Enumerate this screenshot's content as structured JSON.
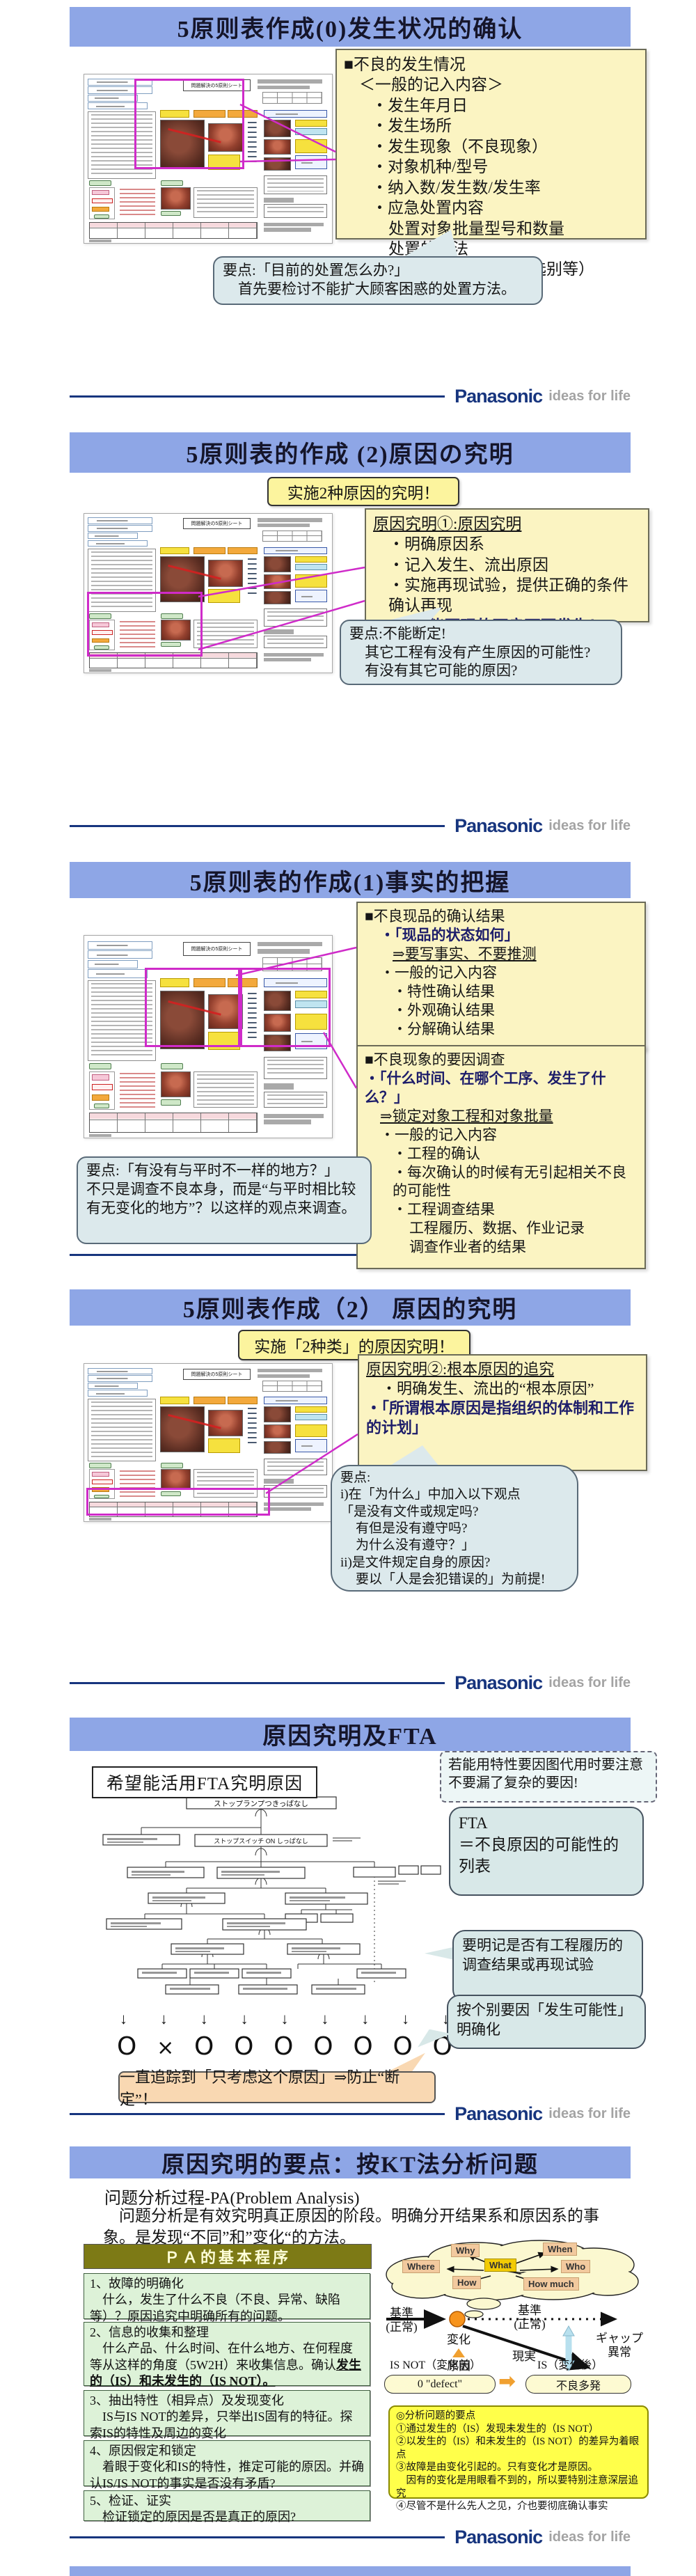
{
  "logo": {
    "brand": "Panasonic",
    "tagline": "ideas for life"
  },
  "form": {
    "title": "問題解決の5原則シート"
  },
  "slide1": {
    "title": "5原则表作成(0)发生状况的确认",
    "info": {
      "l1": "■不良的发生情况",
      "l2": "＜一般的记入内容＞",
      "l3": "・发生年月日",
      "l4": "・发生场所",
      "l5": "・发生现象（不良现象）",
      "l6": "・对象机种/型号",
      "l7": "・纳入数/发生数/发生率",
      "l8": "・应急处置内容",
      "l9": "处置对象批量型号和数量",
      "l10": "处置的方法",
      "l11": "（批量回收、全数选别等）"
    },
    "callout": {
      "l1": "要点:「目前的处置怎么办?」",
      "l2": "首先要检讨不能扩大顾客困惑的处置方法。"
    }
  },
  "slide2": {
    "title": "5原则表的作成 (2)原因の究明",
    "banner": "实施2种原因的究明！",
    "box": {
      "head": "原因究明①:原因究明",
      "l1": "・明确原因系",
      "l2": "・记入发生、流出原因",
      "l3": "・实施再现试验，提供正确的条件确认再现",
      "l4": "・「不能再现的不良可再发生！」"
    },
    "callout": {
      "l1": "要点:不能断定!",
      "l2": "其它工程有没有产生原因的可能性?",
      "l3": "有没有其它可能的原因?"
    }
  },
  "slide3": {
    "title": "5原则表的作成(1)事实的把握",
    "boxA": {
      "l1": "■不良现品的确认结果",
      "l2": "・「现品的状态如何」",
      "l3": "⇒要写事实、不要推测",
      "l4": "・一般的记入内容",
      "l5": "・特性确认结果",
      "l6": "・外观确认结果",
      "l7": "・分解确认结果"
    },
    "boxB": {
      "l1": "■不良现象的要因调查",
      "l2": "・「什么时间、在哪个工序、发生了什么？」",
      "l3": "⇒锁定对象工程和对象批量",
      "l4": "・一般的记入内容",
      "l5": "・工程的确认",
      "l6": "・每次确认的时候有无引起相关不良的可能性",
      "l7": "・工程调查结果",
      "l8": "工程履历、数据、作业记录",
      "l9": "调查作业者的结果"
    },
    "callout": {
      "l1": "要点:「有没有与平时不一样的地方？」",
      "l2": "不只是调查不良本身，而是“与平时相比较有无变化的地方”？以这样的观点来调查。"
    }
  },
  "slide4": {
    "title": "5原则表作成（2） 原因的究明",
    "banner": "实施「2种类」的原因究明！",
    "box": {
      "head": "原因究明②:根本原因的追究",
      "l1": "・明确发生、流出的“根本原因”",
      "l2": "・「所谓根本原因是指组织的体制和工作的计划」"
    },
    "callout": {
      "l1": "要点:",
      "l2": "i)在「为什么」中加入以下观点",
      "l3": "「是没有文件或规定吗?",
      "l4": "有但是没有遵守吗?",
      "l5": "为什么没有遵守？」",
      "l6": "ii)是文件规定自身的原因?",
      "l7": "要以「人是会犯错误的」为前提!"
    }
  },
  "slide5": {
    "title": "原因究明及FTA",
    "headline": "希望能活用FTA究明原因",
    "note": "若能用特性要因图代用时要注意不要漏了复杂的要因!",
    "fta_top": "ストップランプつきっぱなし",
    "fta_mid": "ストップスイッチ ON しっぱなし",
    "callout_fta": "FTA\n＝不良原因的可能性的列表",
    "callout_record": "要明记是否有工程履历的调查结果或再现试验",
    "callout_factor": "按个别要因「发生可能性」明确化",
    "marks": [
      "O",
      "×",
      "O",
      "O",
      "O",
      "O",
      "O",
      "O",
      "O"
    ],
    "trace": "一直追踪到「只考虑这个原因」⇒防止“断定”！"
  },
  "slide6": {
    "title": "原因究明的要点：按KT法分析问题",
    "subtitle": "问题分析过程-PA(Problem Analysis)",
    "para": "　问题分析是有效究明真正原因的阶段。明确分开结果系和原因系的事象。是发现“不同”和”变化“的方法。",
    "pa_header": "ＰＡ的基本程序",
    "steps": [
      {
        "head": "1、故障的明确化",
        "body": "　什么，发生了什么不良（不良、异常、缺陷等）？原因追究中明确所有的问题。",
        "em": ""
      },
      {
        "head": "2、信息的收集和整理",
        "body": "　什么产品、什么时间、在什么地方、在何程度等从这样的角度（5W2H）来收集信息。确认",
        "em": "发生的（IS）和未发生的（IS NOT）。"
      },
      {
        "head": "3、抽出特性（相异点）及发现变化",
        "body": "　IS与IS NOT的差异，只举出IS固有的特征。探索IS的特性及周边的变化",
        "em": ""
      },
      {
        "head": "4、原因假定和锁定",
        "body": "　着眼于变化和IS的特性，推定可能的原因。并确认IS/IS NOT的事实是否没有矛盾?",
        "em": ""
      },
      {
        "head": "5、检证、证实",
        "body": "　检证锁定的原因是否是真正的原因?",
        "em": ""
      }
    ],
    "cloud": {
      "why": "Why",
      "when": "When",
      "where": "Where",
      "what": "What",
      "who": "Who",
      "how": "How",
      "howmuch": "How much"
    },
    "diagram": {
      "base_left": "基準\n(正常)",
      "base_right": "基準\n(正常)",
      "change": "変化",
      "cause": "原因",
      "reality": "現実",
      "gap": "ギャップ\n異常",
      "isnot_label": "IS NOT（変化前）",
      "isnot_pill": "0 \"defect\"",
      "is_label": "IS（変化後）",
      "is_pill": "不良多発"
    },
    "points": {
      "l1": "◎分析问题的要点",
      "l2": "①通过发生的（IS）发现未发生的（IS NOT）",
      "l3": "②以发生的（IS）和未发生的（IS NOT）的差异为着眼点",
      "l4": "③故障是由变化引起的。只有变化才是原因。",
      "l5": "　因有的变化是用眼看不到的，所以要特别注意深层追究",
      "l6": "④尽管不是什么先人之见，介也要彻底确认事实"
    }
  }
}
